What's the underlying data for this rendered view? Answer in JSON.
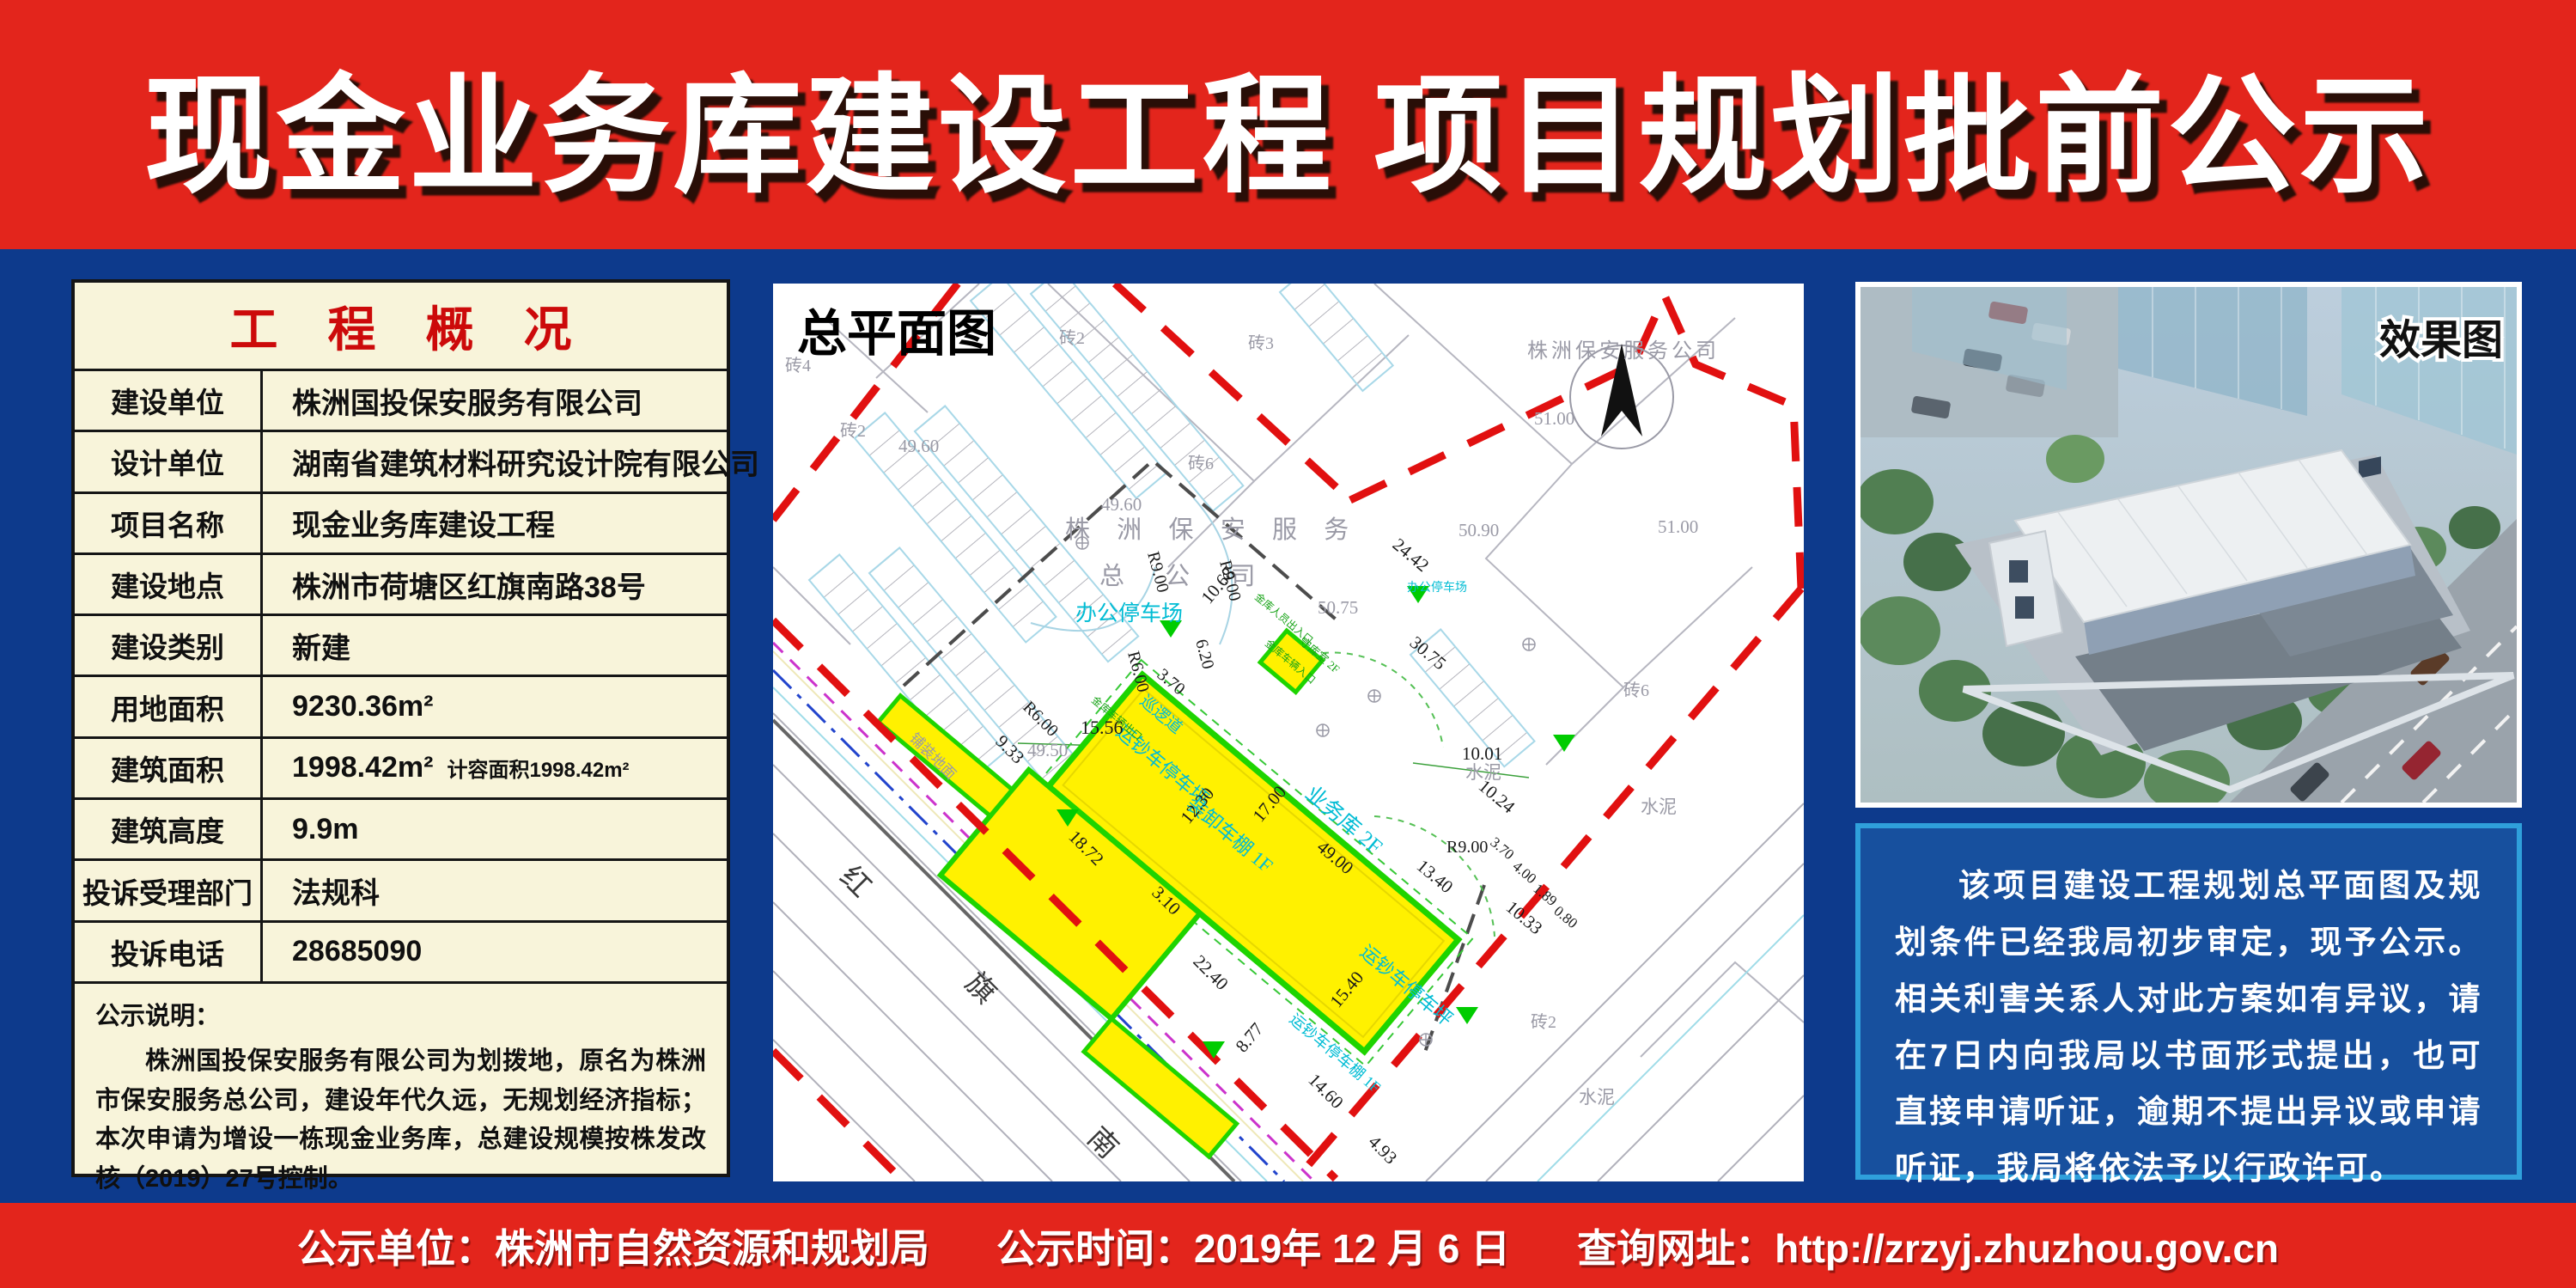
{
  "header": {
    "title": "现金业务库建设工程 项目规划批前公示"
  },
  "overview": {
    "title": "工 程 概 况",
    "rows": [
      {
        "label": "建设单位",
        "value": "株洲国投保安服务有限公司"
      },
      {
        "label": "设计单位",
        "value": "湖南省建筑材料研究设计院有限公司"
      },
      {
        "label": "项目名称",
        "value": "现金业务库建设工程"
      },
      {
        "label": "建设地点",
        "value": "株洲市荷塘区红旗南路38号"
      },
      {
        "label": "建设类别",
        "value": "新建"
      },
      {
        "label": "用地面积",
        "value": "9230.36m²"
      },
      {
        "label": "建筑面积",
        "value": "1998.42m²",
        "note": "计容面积1998.42m²"
      },
      {
        "label": "建筑高度",
        "value": "9.9m"
      },
      {
        "label": "投诉受理部门",
        "value": "法规科"
      },
      {
        "label": "投诉电话",
        "value": "28685090"
      }
    ],
    "note_title": "公示说明：",
    "note_body": "株洲国投保安服务有限公司为划拨地，原名为株洲市保安服务总公司，建设年代久远，无规划经济指标；本次申请为增设一栋现金业务库，总建设规模按株发改核（2019）27号控制。"
  },
  "siteplan": {
    "title": "总平面图",
    "labels": [
      "株洲保安服务公司",
      "株 洲 保 安 服 务",
      "总  公  司",
      "办公停车场",
      "办公停车场",
      "运钞车停车坪",
      "运钞车停车坪",
      "装卸车棚 1F",
      "业务库 2F",
      "运钞车停车棚 1F",
      "守库室 2F",
      "巡逻道",
      "金库车辆出口",
      "金库人员出入口",
      "金库车辆入口",
      "红",
      "旗",
      "南",
      "砖4",
      "砖2",
      "砖2",
      "砖3",
      "砖6",
      "砖6",
      "砖2",
      "水泥",
      "水泥",
      "水泥",
      "铺装地面",
      "49.60",
      "49.60",
      "49.50",
      "51.00",
      "51.00",
      "50.90",
      "50.75",
      "30.75",
      "24.42",
      "15.56",
      "9.33",
      "18.72",
      "22.40",
      "3.10",
      "12.30",
      "17.00",
      "49.00",
      "13.40",
      "10.01",
      "10.24",
      "10.33",
      "15.40",
      "8.77",
      "14.60",
      "4.93",
      "10.68",
      "6.20",
      "3.70",
      "R9.00",
      "R9.00",
      "R6.00",
      "R6.00",
      "R9.00",
      "3.70",
      "4.00",
      "1.89",
      "0.80"
    ]
  },
  "render": {
    "title": "效果图"
  },
  "notice": {
    "body": "该项目建设工程规划总平面图及规划条件已经我局初步审定，现予公示。相关利害关系人对此方案如有异议，请在7日内向我局以书面形式提出，也可直接申请听证，逾期不提出异议或申请听证，我局将依法予以行政许可。",
    "sign1": "株洲市自然资源和规划局",
    "sign2": "2019年12月6日"
  },
  "footer": {
    "unit_label": "公示单位：",
    "unit": "株洲市自然资源和规划局",
    "time_label": "公示时间：",
    "time": "2019年 12 月 6 日",
    "url_label": "查询网址：",
    "url": "http://zrzyj.zhuzhou.gov.cn"
  },
  "colors": {
    "banner_red": "#E3251C",
    "page_navy": "#0D3A8C",
    "table_cream": "#F8F4DA",
    "title_red": "#CC0A0A",
    "plot_yellow": "#FFF100",
    "plot_green": "#1ED400",
    "boundary_red": "#E11010",
    "cad_cyan": "#00BCD4",
    "notice_fill": "#17509E",
    "notice_border": "#2FA0DB"
  }
}
